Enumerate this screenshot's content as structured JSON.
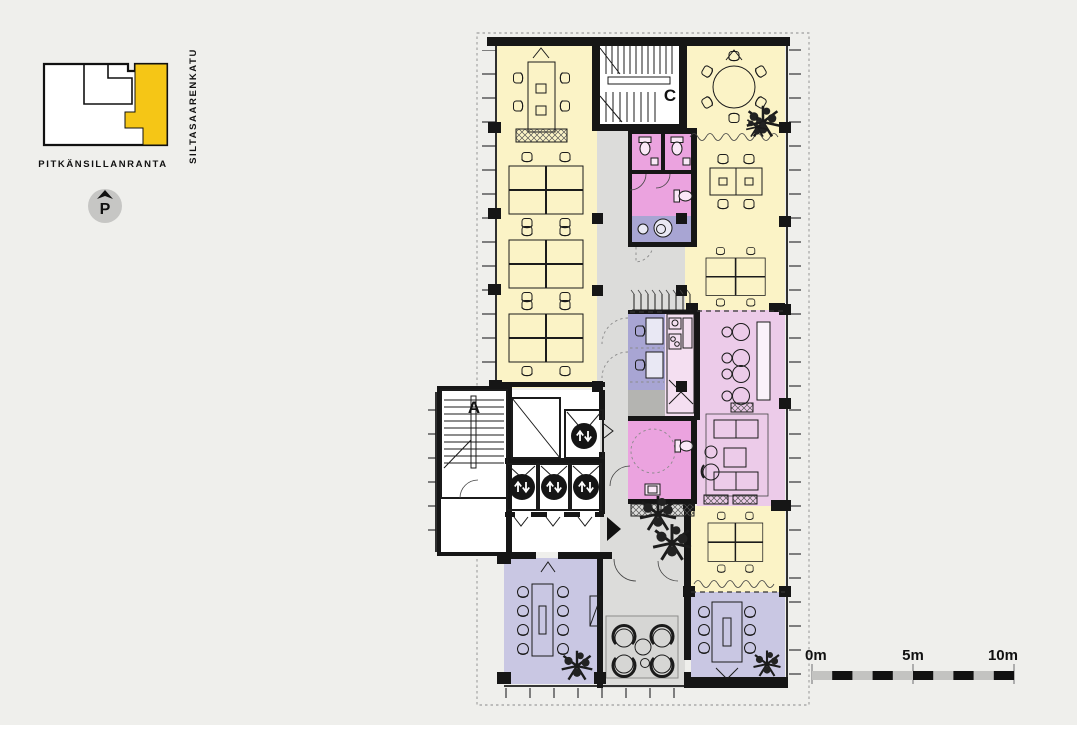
{
  "colors": {
    "bg": "#efefec",
    "yellow": "#fbf3c6",
    "yellow_bright": "#f5c616",
    "pink": "#eba3df",
    "pink_light": "#eccbe9",
    "pink_pale": "#f4dff1",
    "lilac": "#c9c7e3",
    "lilac_dark": "#a8a5d3",
    "corridor": "#dcdcda",
    "closet": "#b4b4b1",
    "rug": "#d6d6d4",
    "scale_gray": "#c3c3c1"
  },
  "locator": {
    "street_bottom": "PITKÄNSILLANRANTA",
    "street_right": "SILTASAARENKATU",
    "parking_label": "P"
  },
  "plan": {
    "stair_a_label": "A",
    "stair_c_label": "C"
  },
  "scalebar": {
    "label_0": "0m",
    "label_5": "5m",
    "label_10": "10m"
  }
}
